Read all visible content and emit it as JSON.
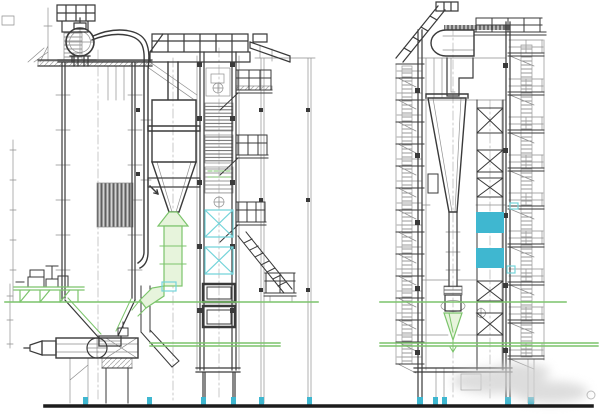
{
  "canvas": {
    "width": 600,
    "height": 416,
    "background": "#ffffff"
  },
  "colors": {
    "line": "#3a3a3a",
    "line_light": "#8f8f8f",
    "line_faint": "#bdbdbd",
    "green": "#7cc46c",
    "green_fill": "#e7f4dc",
    "cyan_line": "#74d4da",
    "cyan_fill": "#3fb7d0",
    "steel_band": "#6a6a6a",
    "ground": "#1c1c1c",
    "watermark": "#d2d2d2"
  },
  "drawing": {
    "kind": "boiler-general-arrangement-elevation",
    "views": [
      {
        "id": "front-elevation",
        "components": [
          "steam-drum",
          "drum-access-cage",
          "downcomer-pipes",
          "furnace",
          "heat-exchanger-hatch",
          "cyclone-separator",
          "loopseal-return-leg",
          "burner-assembly",
          "bottom-hopper",
          "backpass-tower",
          "tube-bundles",
          "bracing-x-panels",
          "air-heater-boxes",
          "side-platforms",
          "access-stair",
          "support-columns",
          "green-operating-platform",
          "feed-pump"
        ]
      },
      {
        "id": "side-elevation",
        "components": [
          "drum-end",
          "roof-stair",
          "stepped-flue-duct",
          "cyclone-cone",
          "standpipe",
          "seal-pot",
          "bracing-x-panels",
          "cyan-duct-sections",
          "ladder-stack",
          "platform-stack",
          "support-columns"
        ]
      }
    ],
    "floor_levels": [
      "upper-operating-floor",
      "lower-operating-floor"
    ],
    "ground": "grade-line",
    "watermark": "illegible-gray-smudge"
  }
}
